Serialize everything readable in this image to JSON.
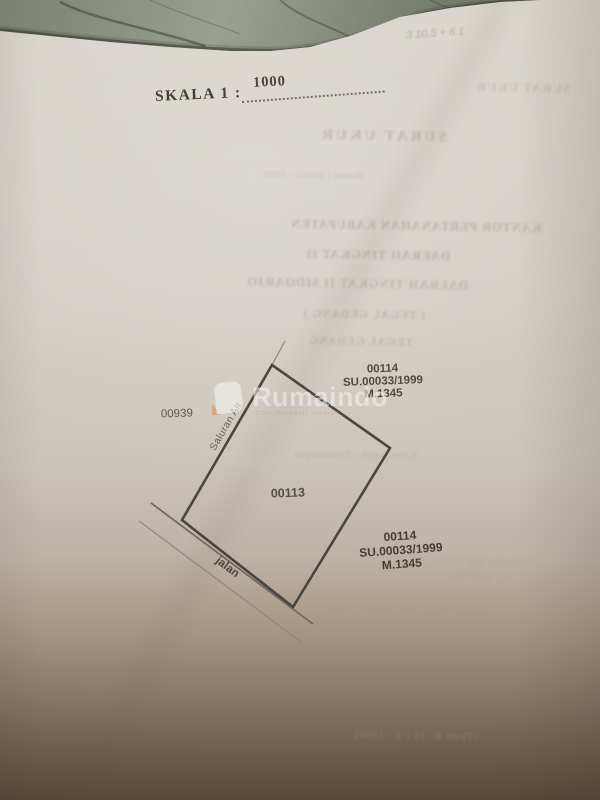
{
  "scale": {
    "label": "SKALA 1 :",
    "value": "1000"
  },
  "sketch": {
    "parcel_number": "00113",
    "west_parcel_number": "00939",
    "northeast_parcel": {
      "number": "00114",
      "survey": "SU.00033/1999",
      "map": "M.1345"
    },
    "southeast_parcel": {
      "number": "00114",
      "survey": "SU.00033/1999",
      "map": "M.1345"
    },
    "drain_label": "Saluran Air",
    "road_label": "jalan"
  },
  "watermark": {
    "brand": "Rumaindo",
    "tagline": "Cari Properti Idaman"
  },
  "ghosts": [
    {
      "text": "SURAT UKUR"
    },
    {
      "text": "SURAT UKUR"
    },
    {
      "text": "Nomor : 00033 / 1999"
    },
    {
      "text": "KANTOR PERTANAHAN KABUPATEN"
    },
    {
      "text": "DAERAH TINGKAT II"
    },
    {
      "text": "DAERAH TINGKAT II SIDOARJO"
    },
    {
      "text": "( TEGAL GEDANG )"
    },
    {
      "text": "TEGAL GEDANG"
    },
    {
      "text": "Keterangan : Pekarangan"
    },
    {
      "text": "Sertipikat Hak Milik"
    },
    {
      "text": "No. 1345 Desa"
    },
    {
      "text": "Gambar Situasi No. 00033 / 1999"
    },
    {
      "text": "(Tham R. 16 - 4 - 1999)"
    },
    {
      "text": "3 10,5 + 6 1"
    },
    {
      "text": "1345"
    }
  ]
}
